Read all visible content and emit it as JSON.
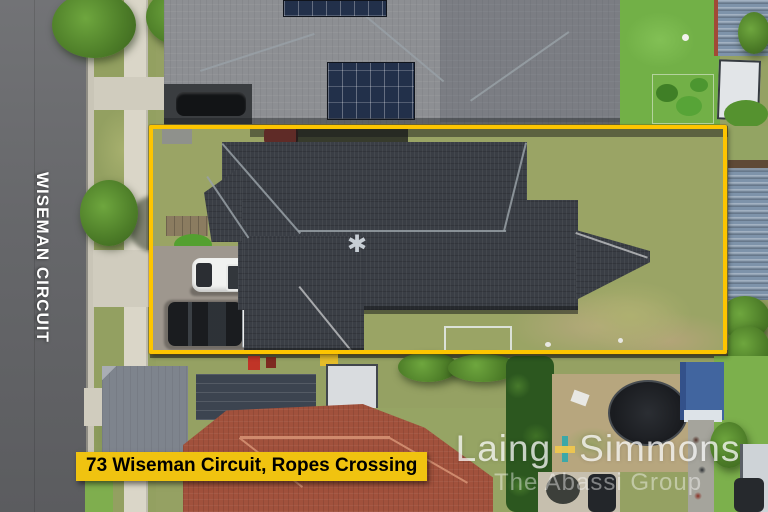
{
  "meta": {
    "type": "real-estate aerial drone photograph",
    "width_px": 768,
    "height_px": 512
  },
  "overlays": {
    "street_label": "WISEMAN CIRCUIT",
    "address_banner": "73 Wiseman Circuit, Ropes Crossing",
    "boundary_color": "#FDC500",
    "banner_bg": "#F0C310",
    "banner_text_color": "#000000",
    "street_label_color": "#FFFFFF"
  },
  "watermark": {
    "brand_left": "Laing",
    "brand_right": "Simmons",
    "plus_glyph": "+",
    "tagline": "The Abassi Group",
    "plus_yellow": "#F2C94C",
    "plus_teal": "#2FA8AD",
    "text_color": "#FFFFFF"
  },
  "scene": {
    "description": "Aerial view of 73 Wiseman Circuit, Ropes Crossing: single-storey home with dark charcoal hip roof outlined by a yellow property boundary, driveway with a white van and a black utility with white tray, Wiseman Circuit road to the left, neighbouring roofs with solar panels above, red tiled roof and trampoline below."
  }
}
